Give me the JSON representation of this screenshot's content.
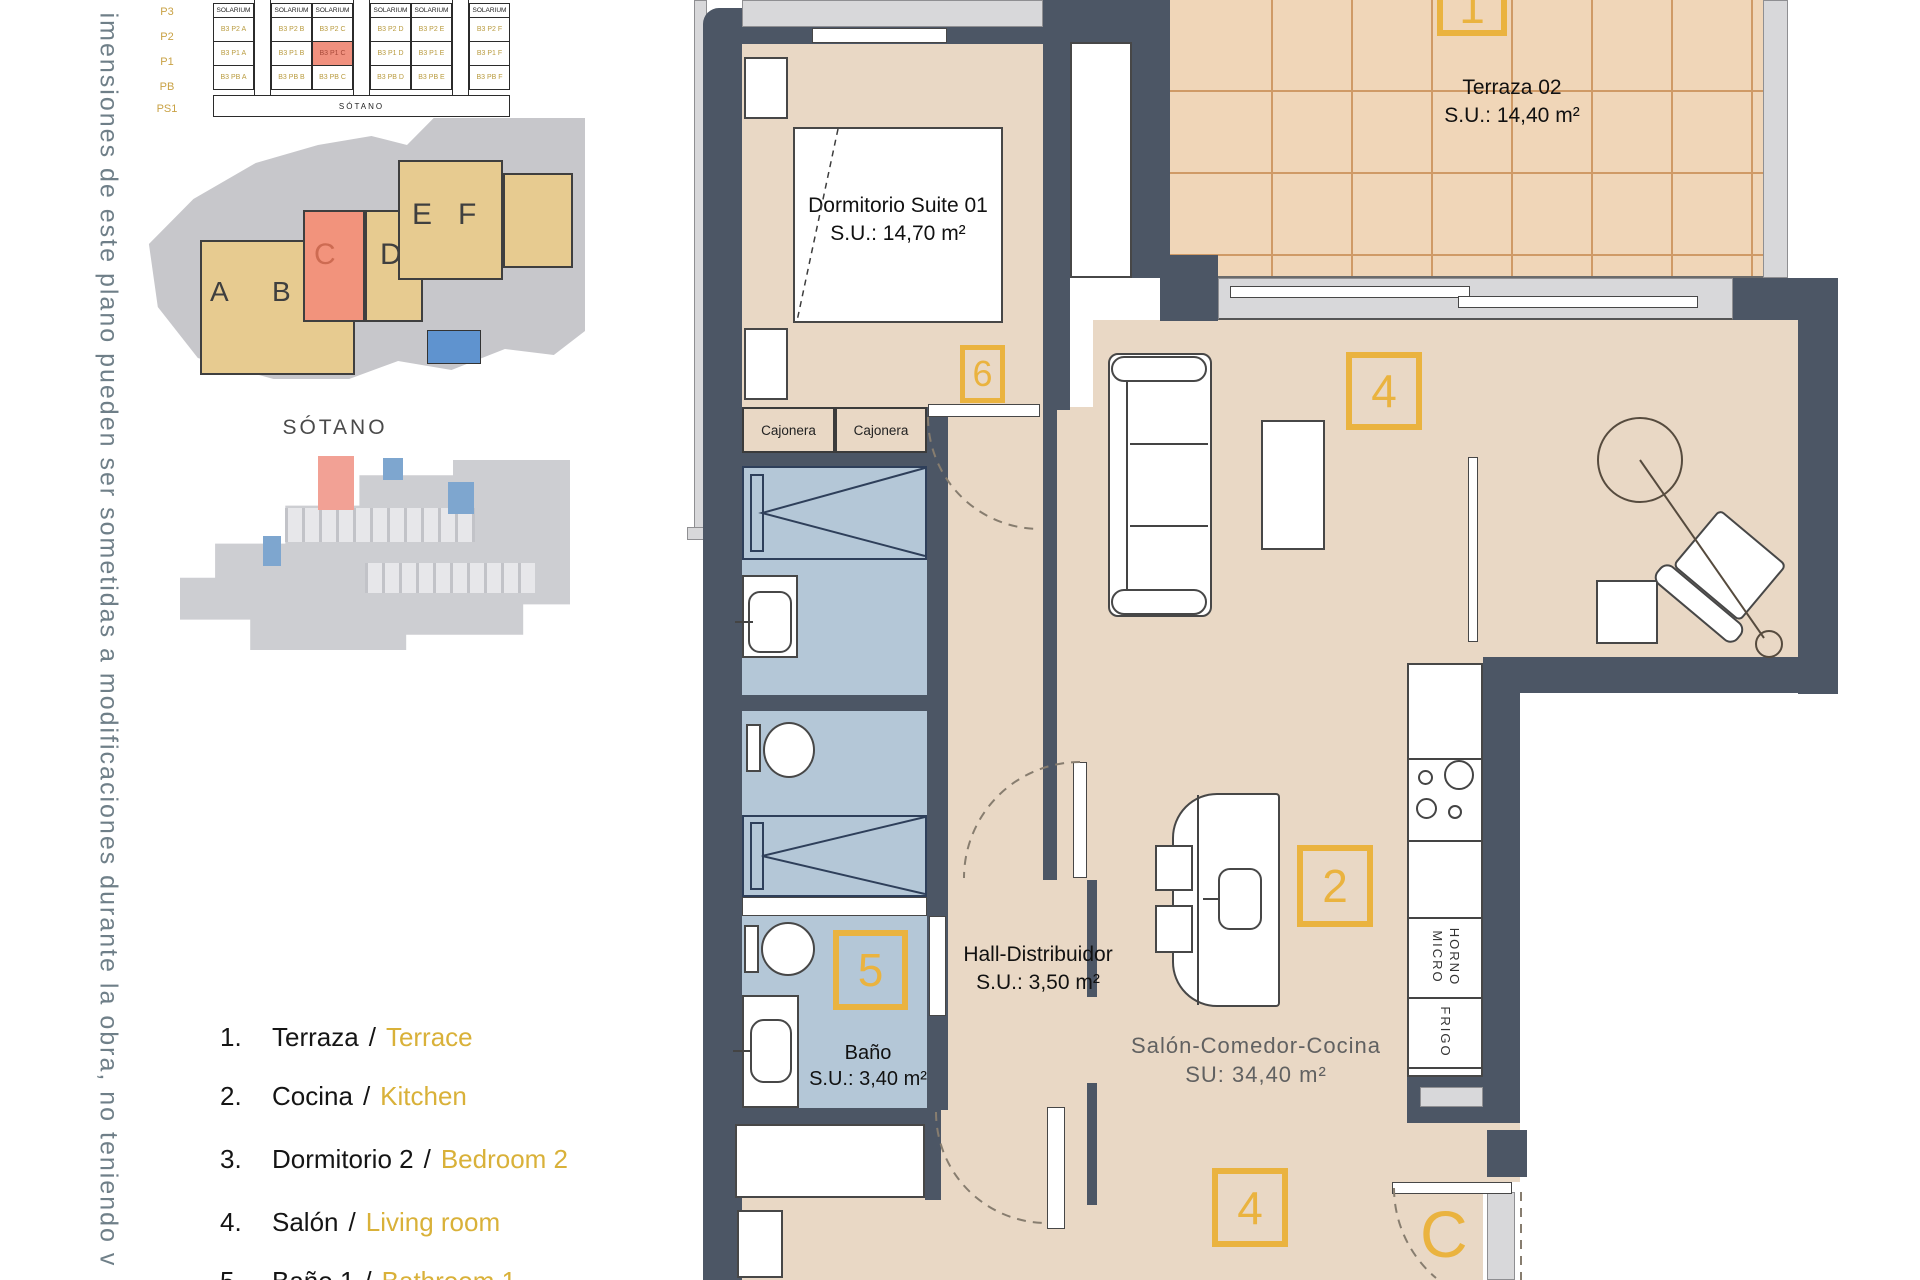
{
  "disclaimer": "imensiones de este plano pueden ser sometidas a modificaciones durante la obra, no teniendo v",
  "colors": {
    "accent_gold": "#eab33f",
    "wall_slate": "#4c5665",
    "highlight_salmon": "#f0907e",
    "floor_tan": "#e9d8c5",
    "wet_room_blue": "#b4c7d7"
  },
  "elevation": {
    "header": "SOLARIUM",
    "floors": [
      "P3",
      "P2",
      "P1",
      "PB",
      "PS1"
    ],
    "basement_row_label": "SÓTANO",
    "units": {
      "P2": [
        "B3 P2 A",
        "B3 P2 B",
        "B3 P2 C",
        "B3 P2 D",
        "B3 P2 E",
        "B3 P2 F"
      ],
      "P1": [
        "B3 P1 A",
        "B3 P1 B",
        "B3 P1 C",
        "B3 P1 D",
        "B3 P1 E",
        "B3 P1 F"
      ],
      "PB": [
        "B3 PB A",
        "B3 PB B",
        "B3 PB C",
        "B3 PB D",
        "B3 PB E",
        "B3 PB F"
      ]
    },
    "highlighted_unit": "B3 P1 C"
  },
  "site_plan": {
    "blocks": [
      "A",
      "B",
      "C",
      "D",
      "E",
      "F"
    ],
    "highlighted_block": "C"
  },
  "sotano": {
    "label": "SÓTANO"
  },
  "legend": {
    "sep": "/",
    "items": [
      {
        "num": "1.",
        "es": "Terraza",
        "en": "Terrace"
      },
      {
        "num": "2.",
        "es": "Cocina",
        "en": "Kitchen"
      },
      {
        "num": "3.",
        "es": "Dormitorio 2",
        "en": "Bedroom 2"
      },
      {
        "num": "4.",
        "es": "Salón",
        "en": "Living room"
      },
      {
        "num": "5.",
        "es": "Baño 1",
        "en": "Bathroom 1"
      }
    ]
  },
  "rooms": {
    "suite": {
      "name": "Dormitorio Suite 01",
      "area": "S.U.: 14,70 m²"
    },
    "terraza": {
      "name": "Terraza 02",
      "area": "S.U.: 14,40 m²"
    },
    "hall": {
      "name": "Hall-Distribuidor",
      "area": "S.U.: 3,50 m²"
    },
    "bano": {
      "name": "Baño",
      "area": "S.U.: 3,40 m²"
    },
    "salon": {
      "name": "Salón-Comedor-Cocina",
      "area": "SU: 34,40 m²"
    }
  },
  "markers": {
    "terraza": "1",
    "cocina": "2",
    "salon": "4",
    "salon_b": "4",
    "bano": "5",
    "suite": "6",
    "unit_letter": "C"
  },
  "fixtures": {
    "cajonera": "Cajonera",
    "horno": "HORNO",
    "micro": "MICRO",
    "frigo": "FRIGO"
  }
}
